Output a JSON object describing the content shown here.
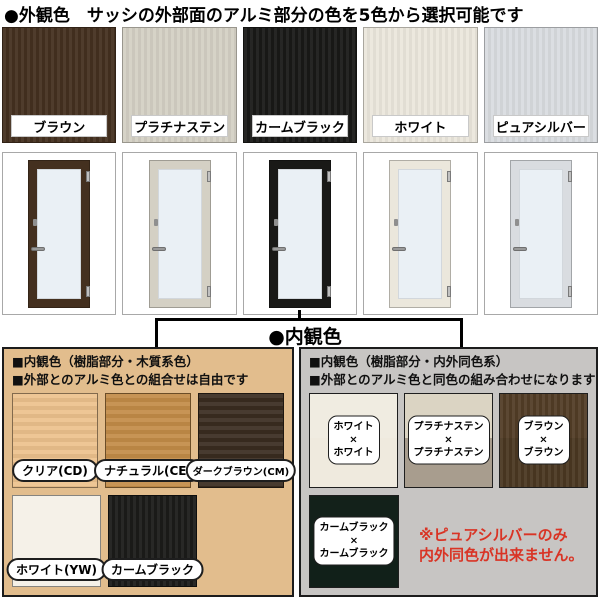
{
  "page": {
    "title": "●外観色　サッシの外部面のアルミ部分の色を5色から選択可能です",
    "interior_title": "●内観色"
  },
  "exterior": {
    "glass_hex": "#eaf0f5",
    "colors": [
      {
        "label": "ブラウン",
        "hex": "#44301f"
      },
      {
        "label": "プラチナステン",
        "hex": "#d4d0c4"
      },
      {
        "label": "カームブラック",
        "hex": "#191917"
      },
      {
        "label": "ホワイト",
        "hex": "#ebe7dc"
      },
      {
        "label": "ピュアシルバー",
        "hex": "#d9dce0"
      }
    ]
  },
  "interior_left": {
    "heading_line1": "■内観色（樹脂部分・木質系色）",
    "heading_line2": "■外部とのアルミ色との組合せは自由です",
    "panel_hex": "#e2bd8d",
    "swatches": [
      {
        "label": "クリア(CD)",
        "hex": "#edc28d"
      },
      {
        "label": "ナチュラル(CE)",
        "hex": "#c38c48"
      },
      {
        "label": "ダークブラウン(CM)",
        "hex": "#3a2c20"
      },
      {
        "label": "ホワイト(YW)",
        "hex": "#f5f1e8"
      },
      {
        "label": "カームブラック",
        "hex": "#1b1b19"
      }
    ]
  },
  "interior_right": {
    "heading_line1": "■内観色（樹脂部分・内外同色系）",
    "heading_line2": "■外部とのアルミ色と同色の組み合わせになります",
    "panel_hex": "#c7c5c3",
    "multiply_sign": "×",
    "combos": [
      {
        "top": "ホワイト",
        "bottom": "ホワイト",
        "hex_top": "#f0ece1",
        "hex_bottom": "#efeade"
      },
      {
        "top": "プラチナステン",
        "bottom": "プラチナステン",
        "hex_top": "#dbd4c3",
        "hex_bottom": "#a89d8e"
      },
      {
        "top": "ブラウン",
        "bottom": "ブラウン",
        "hex_top": "#523d26",
        "hex_bottom": "#4a3721"
      },
      {
        "top": "カームブラック",
        "bottom": "カームブラック",
        "hex_top": "#13211a",
        "hex_bottom": "#112019"
      }
    ],
    "note_line1": "※ピュアシルバーのみ",
    "note_line2": "内外同色が出来ません。",
    "note_hex": "#d93425"
  }
}
